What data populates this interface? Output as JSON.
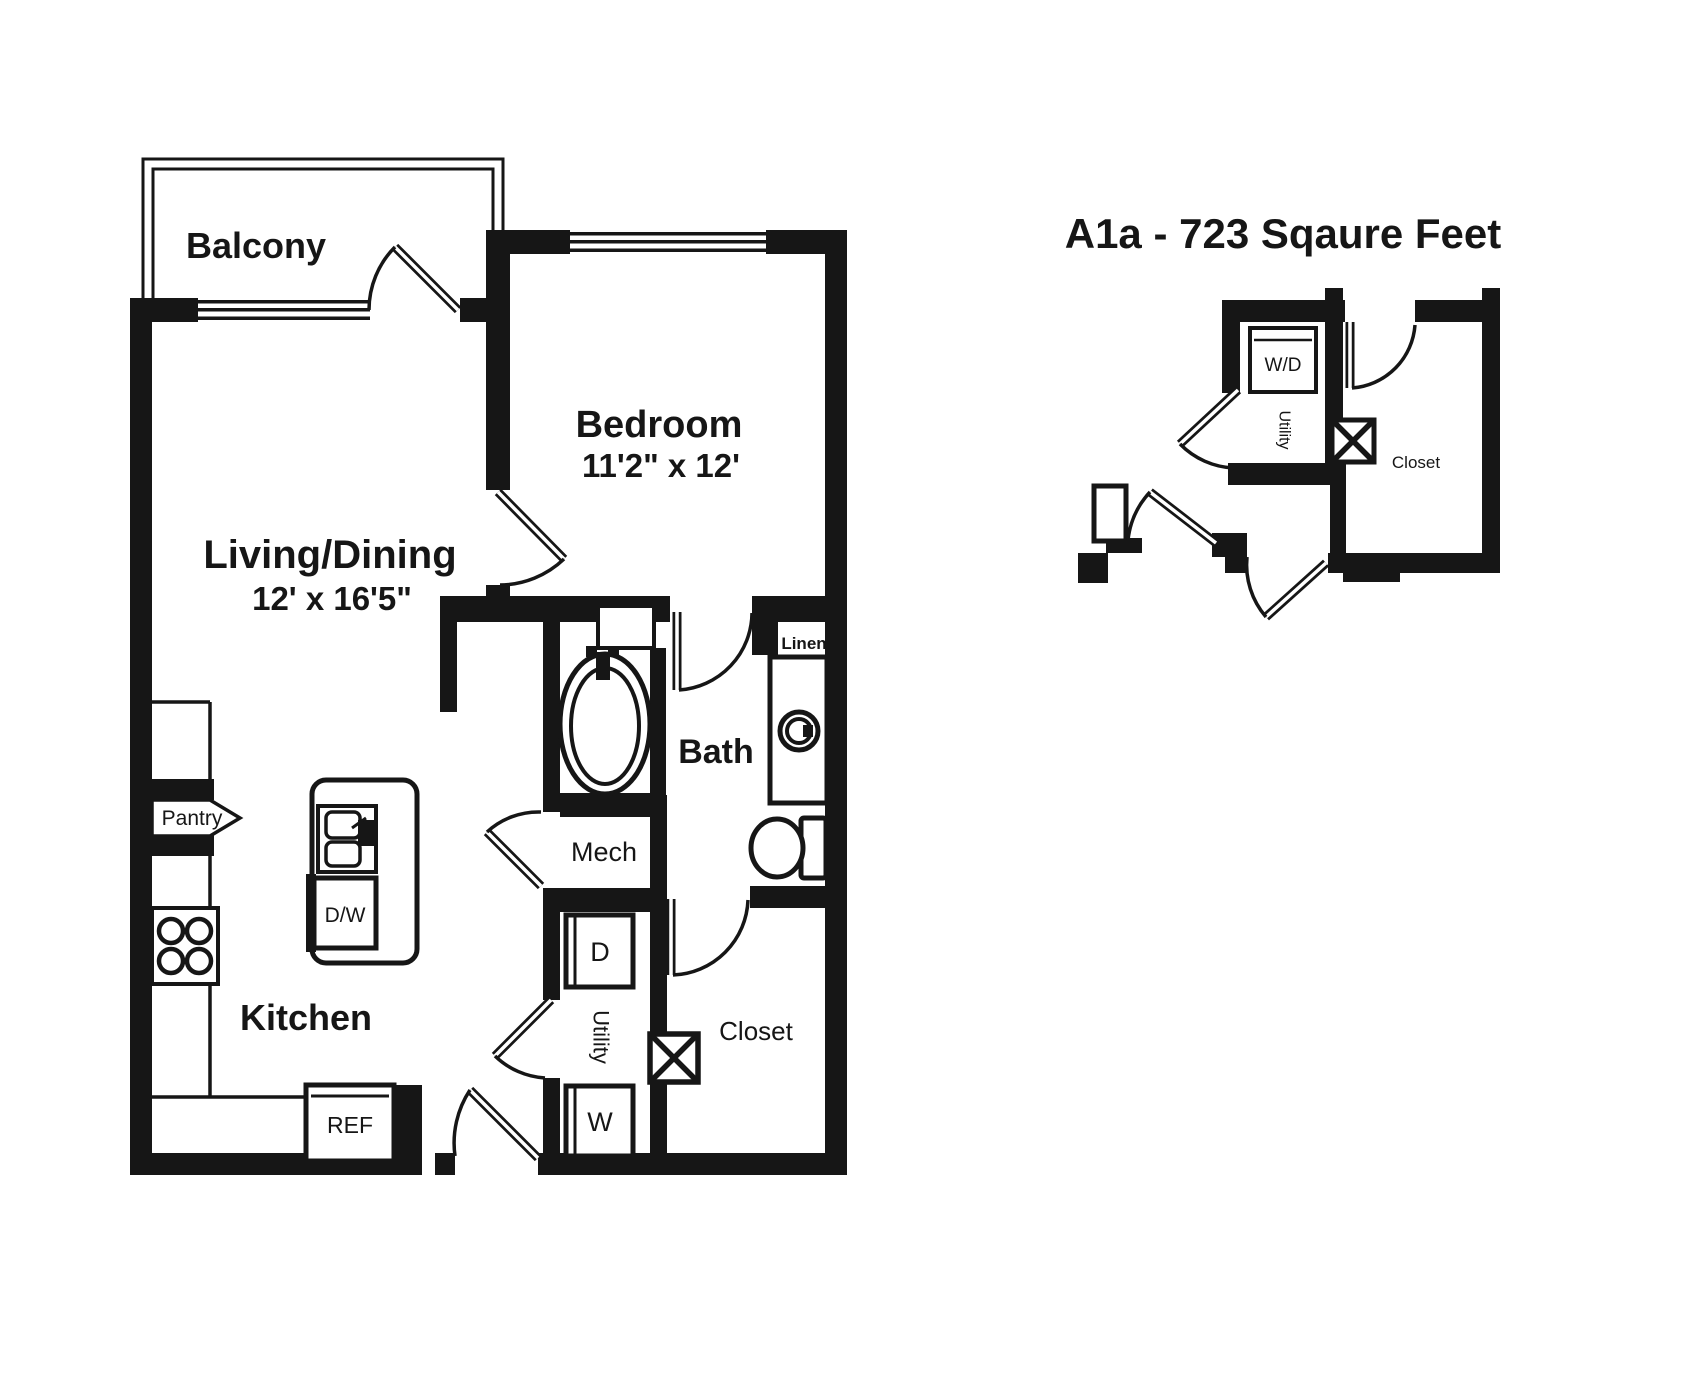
{
  "title": "A1a - 723 Sqaure Feet",
  "colors": {
    "ink": "#161616",
    "paper": "#ffffff"
  },
  "main_plan": {
    "balcony_label": "Balcony",
    "living_label": "Living/Dining",
    "living_dims": "12' x 16'5\"",
    "bedroom_label": "Bedroom",
    "bedroom_dims": "11'2\" x 12'",
    "bath_label": "Bath",
    "kitchen_label": "Kitchen",
    "mech_label": "Mech",
    "utility_label": "Utility",
    "closet_label": "Closet",
    "pantry_label": "Pantry",
    "linen_label": "Linen",
    "ref_label": "REF",
    "dw_label": "D/W",
    "dryer_label": "D",
    "washer_label": "W"
  },
  "detail_plan": {
    "wd_label": "W/D",
    "utility_label": "Utility",
    "closet_label": "Closet"
  }
}
